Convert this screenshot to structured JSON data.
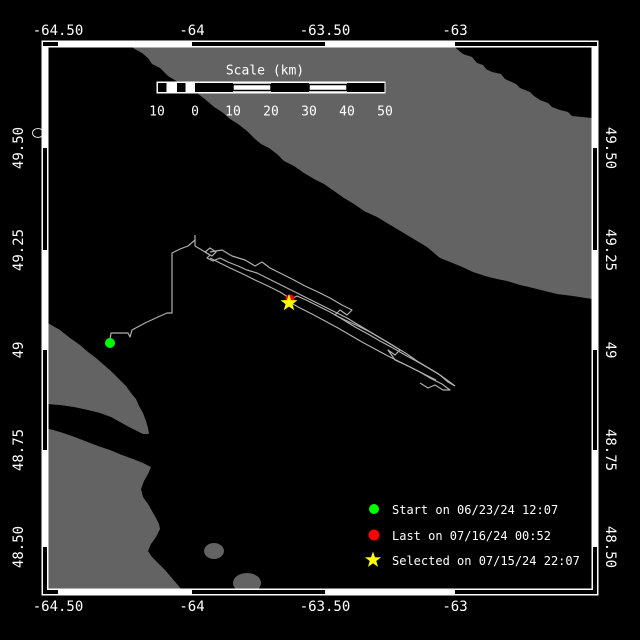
{
  "map": {
    "region_description": "coastal map with vessel/drifter track",
    "lon_axis": {
      "labels": [
        "-64.50",
        "-64",
        "-63.50",
        "-63"
      ]
    },
    "lat_axis": {
      "labels": [
        "49.50",
        "49.25",
        "49",
        "48.75",
        "48.50"
      ]
    }
  },
  "scale_bar": {
    "title": "Scale (km)",
    "ticks": [
      "10",
      "0",
      "10",
      "20",
      "30",
      "40",
      "50"
    ]
  },
  "legend": {
    "items": [
      {
        "symbol": "start-dot",
        "color": "#00ff00",
        "label": "Start on 06/23/24 12:07"
      },
      {
        "symbol": "last-dot",
        "color": "#ff0000",
        "label": "Last on 07/16/24 00:52"
      },
      {
        "symbol": "selected-star",
        "color": "#ffff00",
        "label": "Selected on 07/15/24 22:07"
      }
    ]
  },
  "markers": {
    "start_color": "#00ff00",
    "last_color": "#ff0000",
    "selected_color": "#ffff00"
  },
  "colors": {
    "ocean": "#000000",
    "land": "#636363",
    "track": "#b0b0b0",
    "frame": "#ffffff",
    "text": "#ffffff"
  }
}
